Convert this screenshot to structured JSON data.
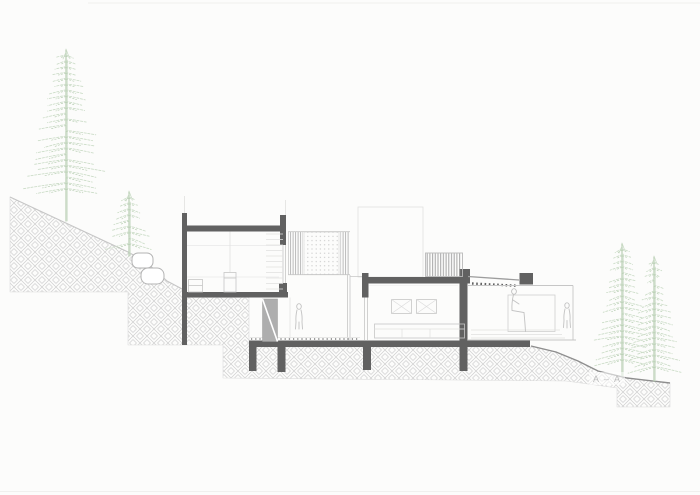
{
  "drawing": {
    "type": "architectural cross-section",
    "section_label": "A – A",
    "colors": {
      "bg": "#fcfcfb",
      "cut": "#616161",
      "light": "#c6c6c6",
      "xlight": "#e0e0df",
      "mid": "#9d9d9d",
      "terrain": "#8e8e8e",
      "hatch": "#cecece",
      "green": "#cbdcc7",
      "green2": "#b9cfb4",
      "stair": "#aeaeae",
      "label": "#bdbdbd",
      "figure": "#c2c2c2"
    },
    "trees": [
      {
        "x": 66,
        "base": 221,
        "top": 46,
        "spread": 46,
        "bare": 30,
        "seed": 11
      },
      {
        "x": 129,
        "base": 256,
        "top": 188,
        "spread": 25,
        "bare": 10,
        "seed": 23
      },
      {
        "x": 622,
        "base": 376,
        "top": 240,
        "spread": 33,
        "bare": 16,
        "seed": 37
      },
      {
        "x": 654,
        "base": 381,
        "top": 253,
        "spread": 27,
        "bare": 14,
        "seed": 51
      }
    ],
    "elements": [
      "stepped-hillside-earth-hatch",
      "two-level-house-section",
      "internal-stair",
      "louvered-and-perforated-screen",
      "roof-terrace-railing",
      "slatted-pergola",
      "boulders-on-slope",
      "pine-trees",
      "human-figures"
    ]
  }
}
